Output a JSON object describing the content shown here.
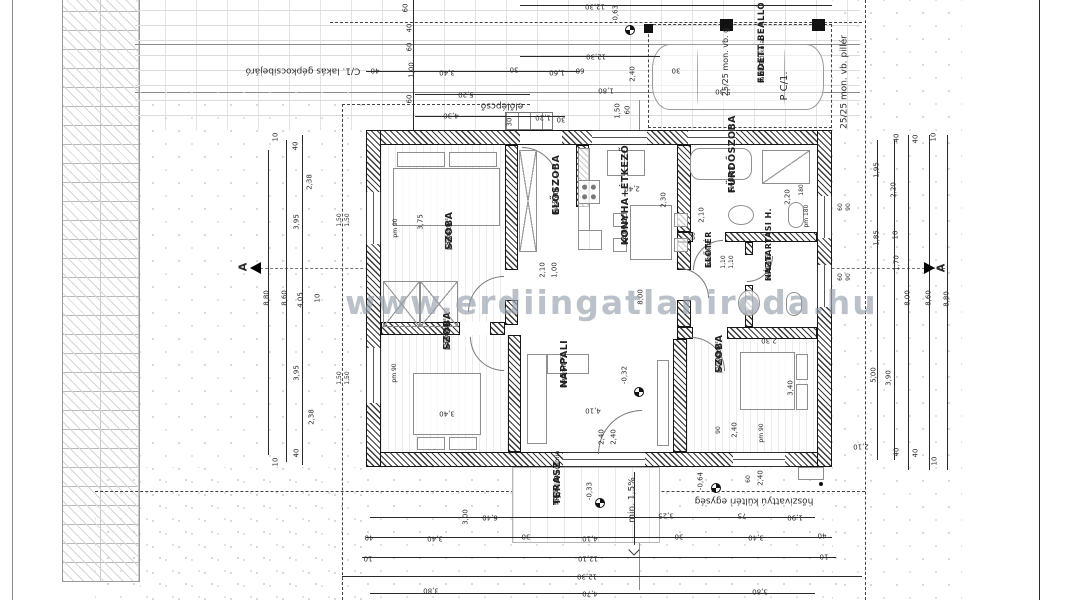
{
  "watermark": {
    "text": "www.erdiingatlaniroda.hu"
  },
  "rooms": [
    {
      "id": "szoba1",
      "name": "SZOBA",
      "material": "parketta",
      "area": "13,61 m²"
    },
    {
      "id": "szoba2",
      "name": "SZOBA",
      "material": "parketta",
      "area": "13,61 m²"
    },
    {
      "id": "nappali",
      "name": "NAPPALI",
      "material": "kerámia",
      "area": "16,21 m²"
    },
    {
      "id": "szoba3",
      "name": "SZOBA",
      "material": "parketta",
      "area": "12,06 m²"
    },
    {
      "id": "eloszoba",
      "name": "ELŐSZOBA",
      "material": "kerámia",
      "area": "4,52 m²"
    },
    {
      "id": "konyha",
      "name": "KONYHA+ÉTKEZŐ",
      "material": "kerámia",
      "area": "12,00 m²"
    },
    {
      "id": "furdoszoba",
      "name": "FÜRDŐSZOBA",
      "material": "kerámia",
      "area": "7,48 m²"
    },
    {
      "id": "eloter",
      "name": "ELŐTÉR",
      "material": "kerámia",
      "area": "1,54 m²"
    },
    {
      "id": "haztartasi",
      "name": "HÁZTARTÁSI H.",
      "material": "kerámia",
      "area": "3,06 m²"
    },
    {
      "id": "terasz",
      "name": "TERASZ",
      "material": "fagyálló kerámia",
      "area": "14,50 m²"
    },
    {
      "id": "carport",
      "name": "FEDETT BEÁLLÓ",
      "material": "térkő burkolat",
      "area": "8,70 m²"
    }
  ],
  "labels": [
    {
      "t": "12,30",
      "x": 595,
      "y": 6,
      "r": 180
    },
    {
      "t": "12,30",
      "x": 596,
      "y": 56,
      "r": 180
    },
    {
      "t": "-0,63",
      "x": 616,
      "y": 14,
      "r": -90,
      "n": "level-label"
    },
    {
      "t": "60",
      "x": 406,
      "y": 8,
      "r": -90
    },
    {
      "t": "40",
      "x": 410,
      "y": 28,
      "r": -90
    },
    {
      "t": "60",
      "x": 410,
      "y": 47,
      "r": -90
    },
    {
      "t": "1,00",
      "x": 412,
      "y": 70,
      "r": -90
    },
    {
      "t": "60",
      "x": 410,
      "y": 99,
      "r": -90
    },
    {
      "t": "40",
      "x": 375,
      "y": 70,
      "r": 180
    },
    {
      "t": "3,40",
      "x": 447,
      "y": 72,
      "r": 180
    },
    {
      "t": "30",
      "x": 514,
      "y": 69,
      "r": 180
    },
    {
      "t": "1,60",
      "x": 557,
      "y": 72,
      "r": 180
    },
    {
      "t": "60",
      "x": 580,
      "y": 70,
      "r": 180
    },
    {
      "t": "5,20",
      "x": 466,
      "y": 94,
      "r": 180
    },
    {
      "t": "4,30",
      "x": 451,
      "y": 115,
      "r": 180
    },
    {
      "t": "1,20",
      "x": 543,
      "y": 117,
      "r": 180
    },
    {
      "t": "30",
      "x": 561,
      "y": 119,
      "r": 180
    },
    {
      "t": "30",
      "x": 510,
      "y": 122,
      "r": -90
    },
    {
      "t": "2,40",
      "x": 633,
      "y": 74,
      "r": -90
    },
    {
      "t": "1,80",
      "x": 606,
      "y": 90,
      "r": 180
    },
    {
      "t": "1,50",
      "x": 618,
      "y": 111,
      "r": -90
    },
    {
      "t": "60",
      "x": 628,
      "y": 110,
      "r": -90
    },
    {
      "t": "30",
      "x": 676,
      "y": 70,
      "r": 180
    },
    {
      "t": "5,30",
      "x": 723,
      "y": 91,
      "r": 180
    },
    {
      "t": "10",
      "x": 276,
      "y": 137,
      "r": -90
    },
    {
      "t": "40",
      "x": 296,
      "y": 146,
      "r": -90
    },
    {
      "t": "2,38",
      "x": 310,
      "y": 182,
      "r": -90
    },
    {
      "t": "3,95",
      "x": 297,
      "y": 222,
      "r": -90
    },
    {
      "t": "1,50",
      "x": 340,
      "y": 220,
      "r": -90,
      "s": 6
    },
    {
      "t": "1,50",
      "x": 348,
      "y": 220,
      "r": -90,
      "s": 6
    },
    {
      "t": "8,80",
      "x": 267,
      "y": 298,
      "r": -90
    },
    {
      "t": "8,60",
      "x": 285,
      "y": 298,
      "r": -90
    },
    {
      "t": "4,05",
      "x": 301,
      "y": 300,
      "r": -90
    },
    {
      "t": "10",
      "x": 318,
      "y": 298,
      "r": -90
    },
    {
      "t": "3,95",
      "x": 297,
      "y": 373,
      "r": -90
    },
    {
      "t": "2,38",
      "x": 312,
      "y": 417,
      "r": -90
    },
    {
      "t": "1,50",
      "x": 340,
      "y": 378,
      "r": -90,
      "s": 6
    },
    {
      "t": "1,50",
      "x": 348,
      "y": 378,
      "r": -90,
      "s": 6
    },
    {
      "t": "40",
      "x": 297,
      "y": 453,
      "r": -90
    },
    {
      "t": "10",
      "x": 276,
      "y": 462,
      "r": -90
    },
    {
      "t": "40",
      "x": 897,
      "y": 138,
      "r": -90
    },
    {
      "t": "40",
      "x": 916,
      "y": 139,
      "r": -90
    },
    {
      "t": "10",
      "x": 934,
      "y": 137,
      "r": -90
    },
    {
      "t": "1,95",
      "x": 877,
      "y": 170,
      "r": -90
    },
    {
      "t": "2,20",
      "x": 894,
      "y": 190,
      "r": -90
    },
    {
      "t": "60",
      "x": 841,
      "y": 207,
      "r": -90,
      "s": 6
    },
    {
      "t": "90",
      "x": 849,
      "y": 207,
      "r": -90,
      "s": 6
    },
    {
      "t": "1,85",
      "x": 877,
      "y": 238,
      "r": -90
    },
    {
      "t": "10",
      "x": 896,
      "y": 235,
      "r": -90
    },
    {
      "t": "1,70",
      "x": 897,
      "y": 263,
      "r": -90
    },
    {
      "t": "60",
      "x": 841,
      "y": 277,
      "r": -90,
      "s": 6
    },
    {
      "t": "90",
      "x": 849,
      "y": 277,
      "r": -90,
      "s": 6
    },
    {
      "t": "8,00",
      "x": 908,
      "y": 298,
      "r": -90
    },
    {
      "t": "8,60",
      "x": 929,
      "y": 298,
      "r": -90
    },
    {
      "t": "8,80",
      "x": 947,
      "y": 299,
      "r": -90
    },
    {
      "t": "5,00",
      "x": 874,
      "y": 375,
      "r": -90
    },
    {
      "t": "3,90",
      "x": 889,
      "y": 378,
      "r": -90
    },
    {
      "t": "40",
      "x": 897,
      "y": 452,
      "r": -90
    },
    {
      "t": "40",
      "x": 916,
      "y": 453,
      "r": -90
    },
    {
      "t": "10",
      "x": 935,
      "y": 461,
      "r": -90
    },
    {
      "t": "2,10",
      "x": 861,
      "y": 446,
      "r": 180
    },
    {
      "t": "6,40",
      "x": 490,
      "y": 517,
      "r": 180
    },
    {
      "t": "3,00",
      "x": 466,
      "y": 517,
      "r": -90
    },
    {
      "t": "3,25",
      "x": 666,
      "y": 515,
      "r": 180
    },
    {
      "t": "75",
      "x": 742,
      "y": 515,
      "r": 180
    },
    {
      "t": "1,90",
      "x": 795,
      "y": 517,
      "r": 180
    },
    {
      "t": "40",
      "x": 369,
      "y": 537,
      "r": 180
    },
    {
      "t": "3,40",
      "x": 435,
      "y": 538,
      "r": 180
    },
    {
      "t": "30",
      "x": 526,
      "y": 536,
      "r": 180
    },
    {
      "t": "4,10",
      "x": 590,
      "y": 538,
      "r": 180
    },
    {
      "t": "30",
      "x": 679,
      "y": 536,
      "r": 180
    },
    {
      "t": "3,40",
      "x": 756,
      "y": 537,
      "r": 180
    },
    {
      "t": "40",
      "x": 822,
      "y": 535,
      "r": 180
    },
    {
      "t": "10",
      "x": 368,
      "y": 558,
      "r": 180
    },
    {
      "t": "12,10",
      "x": 588,
      "y": 558,
      "r": 180
    },
    {
      "t": "10",
      "x": 824,
      "y": 556,
      "r": 180
    },
    {
      "t": "12,30",
      "x": 587,
      "y": 576,
      "r": 180
    },
    {
      "t": "3,80",
      "x": 431,
      "y": 590,
      "r": 180
    },
    {
      "t": "4,70",
      "x": 590,
      "y": 593,
      "r": 180
    },
    {
      "t": "3,80",
      "x": 760,
      "y": 591,
      "r": 180
    },
    {
      "t": "-0,33",
      "x": 590,
      "y": 491,
      "r": -90,
      "n": "level-label"
    },
    {
      "t": "min. 1,5%",
      "x": 633,
      "y": 500,
      "r": -90,
      "s": 9,
      "n": "slope-label"
    },
    {
      "t": "-0,64",
      "x": 701,
      "y": 481,
      "r": -90,
      "n": "level-label"
    },
    {
      "t": "60",
      "x": 749,
      "y": 479,
      "r": -90,
      "s": 6
    },
    {
      "t": "2,40",
      "x": 761,
      "y": 478,
      "r": -90
    },
    {
      "t": "3,75",
      "x": 421,
      "y": 222,
      "r": -90
    },
    {
      "t": "pm 90",
      "x": 396,
      "y": 228,
      "r": -90,
      "s": 6
    },
    {
      "t": "pm 90",
      "x": 395,
      "y": 373,
      "r": -90,
      "s": 6
    },
    {
      "t": "3,40",
      "x": 447,
      "y": 413,
      "r": 180
    },
    {
      "t": "3,40",
      "x": 791,
      "y": 388,
      "r": -90
    },
    {
      "t": "2,10",
      "x": 543,
      "y": 270,
      "r": -90
    },
    {
      "t": "1,00",
      "x": 555,
      "y": 270,
      "r": -90
    },
    {
      "t": "2,40",
      "x": 632,
      "y": 188,
      "r": 180
    },
    {
      "t": "2,30",
      "x": 664,
      "y": 200,
      "r": -90
    },
    {
      "t": "8,00",
      "x": 641,
      "y": 297,
      "r": -90
    },
    {
      "t": "2,10",
      "x": 702,
      "y": 215,
      "r": -90
    },
    {
      "t": "80",
      "x": 694,
      "y": 236,
      "r": -90,
      "s": 6
    },
    {
      "t": "2,20",
      "x": 788,
      "y": 197,
      "r": -90
    },
    {
      "t": "180",
      "x": 802,
      "y": 190,
      "r": -90,
      "s": 6
    },
    {
      "t": "pm 180",
      "x": 807,
      "y": 216,
      "r": -90,
      "s": 6
    },
    {
      "t": "1,10",
      "x": 724,
      "y": 262,
      "r": -90,
      "s": 6
    },
    {
      "t": "1,10",
      "x": 732,
      "y": 262,
      "r": -90,
      "s": 6
    },
    {
      "t": "2,30",
      "x": 769,
      "y": 340,
      "r": 180
    },
    {
      "t": "-0,32",
      "x": 625,
      "y": 375,
      "r": -90,
      "n": "level-label"
    },
    {
      "t": "4,10",
      "x": 593,
      "y": 410,
      "r": 180
    },
    {
      "t": "2,40",
      "x": 602,
      "y": 437,
      "r": -90
    },
    {
      "t": "2,40",
      "x": 614,
      "y": 437,
      "r": -90
    },
    {
      "t": "90",
      "x": 719,
      "y": 430,
      "r": -90,
      "s": 6
    },
    {
      "t": "2,40",
      "x": 735,
      "y": 430,
      "r": -90
    },
    {
      "t": "pm 90",
      "x": 762,
      "y": 433,
      "r": -90,
      "s": 6
    },
    {
      "t": "C/1. lakás gépkocsibejáró",
      "x": 303,
      "y": 70,
      "r": 180,
      "s": 9,
      "n": "annotation-driveway"
    },
    {
      "t": "előlépcső",
      "x": 502,
      "y": 105,
      "r": 180,
      "s": 9,
      "n": "annotation-front-steps"
    },
    {
      "t": "25/25 mon. vb. pillér",
      "x": 845,
      "y": 82,
      "r": -90,
      "s": 9,
      "n": "annotation-pillar"
    },
    {
      "t": "25/25 mon. vb. g",
      "x": 726,
      "y": 62,
      "r": -90,
      "s": 8,
      "n": "annotation-pillar-2"
    },
    {
      "t": "P C/1.",
      "x": 785,
      "y": 86,
      "r": -90,
      "s": 10,
      "n": "annotation-parking-space"
    },
    {
      "t": "hőszivattyú kültéri egység",
      "x": 754,
      "y": 500,
      "r": 180,
      "s": 9,
      "n": "annotation-heat-pump"
    },
    {
      "t": "A",
      "x": 243,
      "y": 267,
      "r": -90,
      "s": 11,
      "b": 1,
      "n": "section-mark-a-left"
    },
    {
      "t": "A",
      "x": 941,
      "y": 268,
      "r": -90,
      "s": 11,
      "b": 1,
      "n": "section-mark-a-right"
    }
  ]
}
